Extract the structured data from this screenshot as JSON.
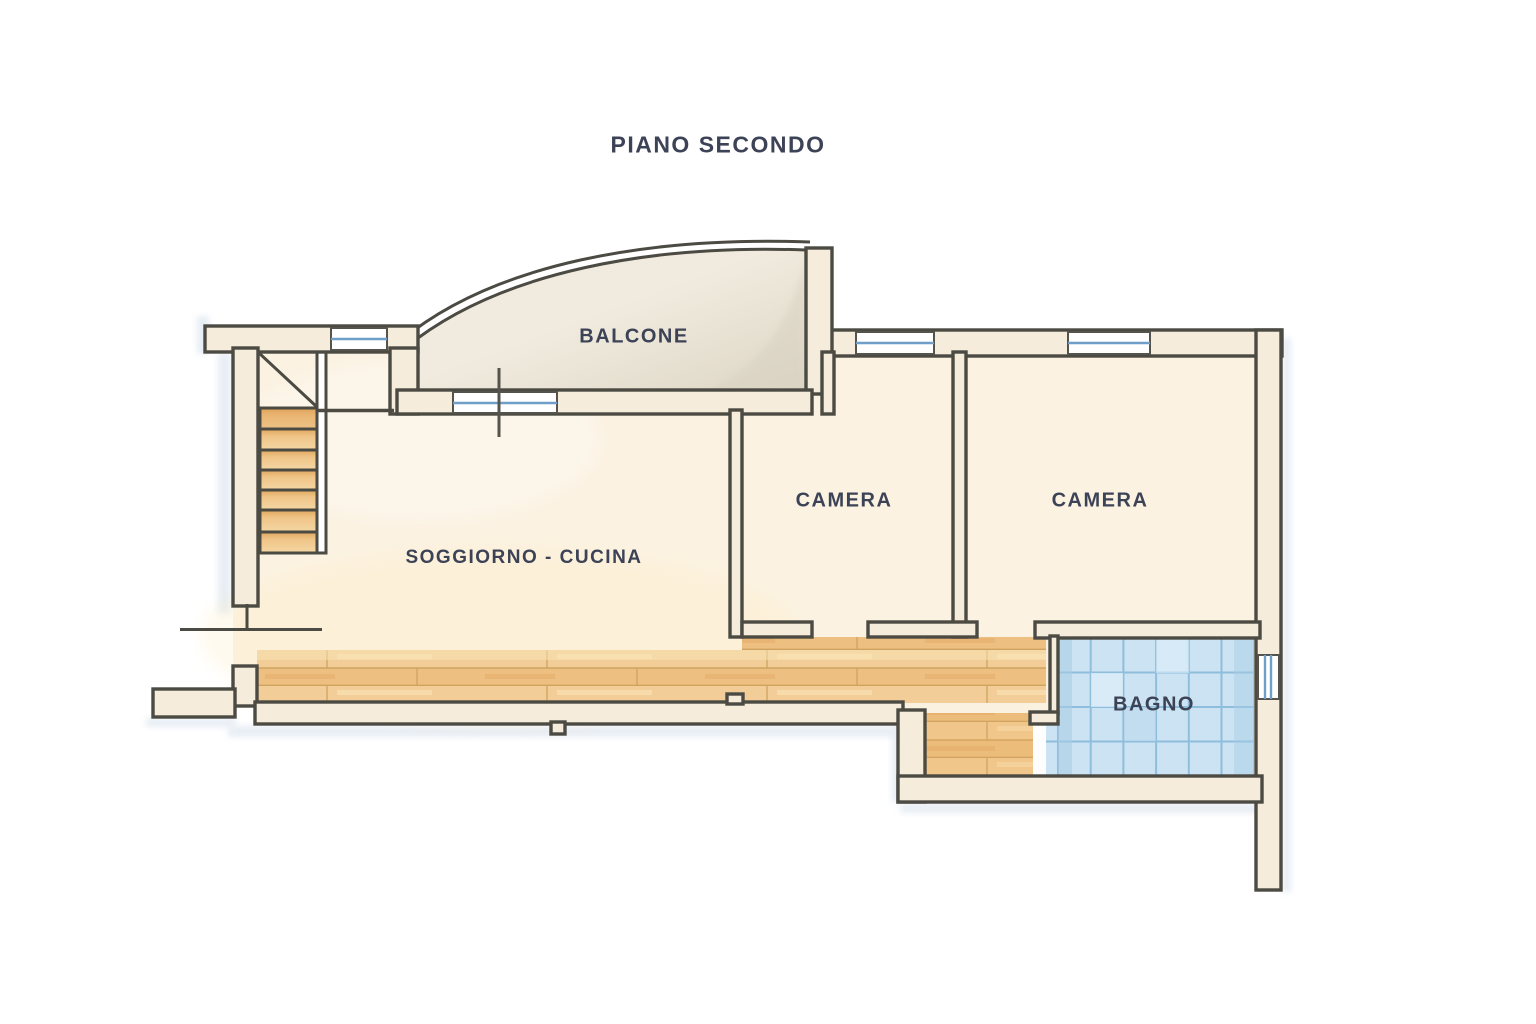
{
  "title": "PIANO SECONDO",
  "plan": {
    "balcone": {
      "label": "BALCONE"
    },
    "soggiorno": {
      "label": "SOGGIORNO - CUCINA"
    },
    "camera1": {
      "label": "CAMERA"
    },
    "camera2": {
      "label": "CAMERA"
    },
    "bagno": {
      "label": "BAGNO"
    }
  },
  "features": [
    "staircase",
    "balcony-railing",
    "windows",
    "wood-flooring",
    "tiled-flooring",
    "door-openings"
  ],
  "colors": {
    "wall_line": "#4b4a43",
    "wall_fill": "#f5ecdb",
    "room_fill": "#fbf2e2",
    "balcony_fill": "#efe9dc",
    "wood_floor": "#f0c88e",
    "wood_seam": "#cfa35f",
    "tile_floor": "#cbe3f2",
    "tile_grout": "#8fbedd",
    "window_accent": "#6f9ec9",
    "outside_shadow": "#cfdcea",
    "label_text": "#3d4356"
  }
}
